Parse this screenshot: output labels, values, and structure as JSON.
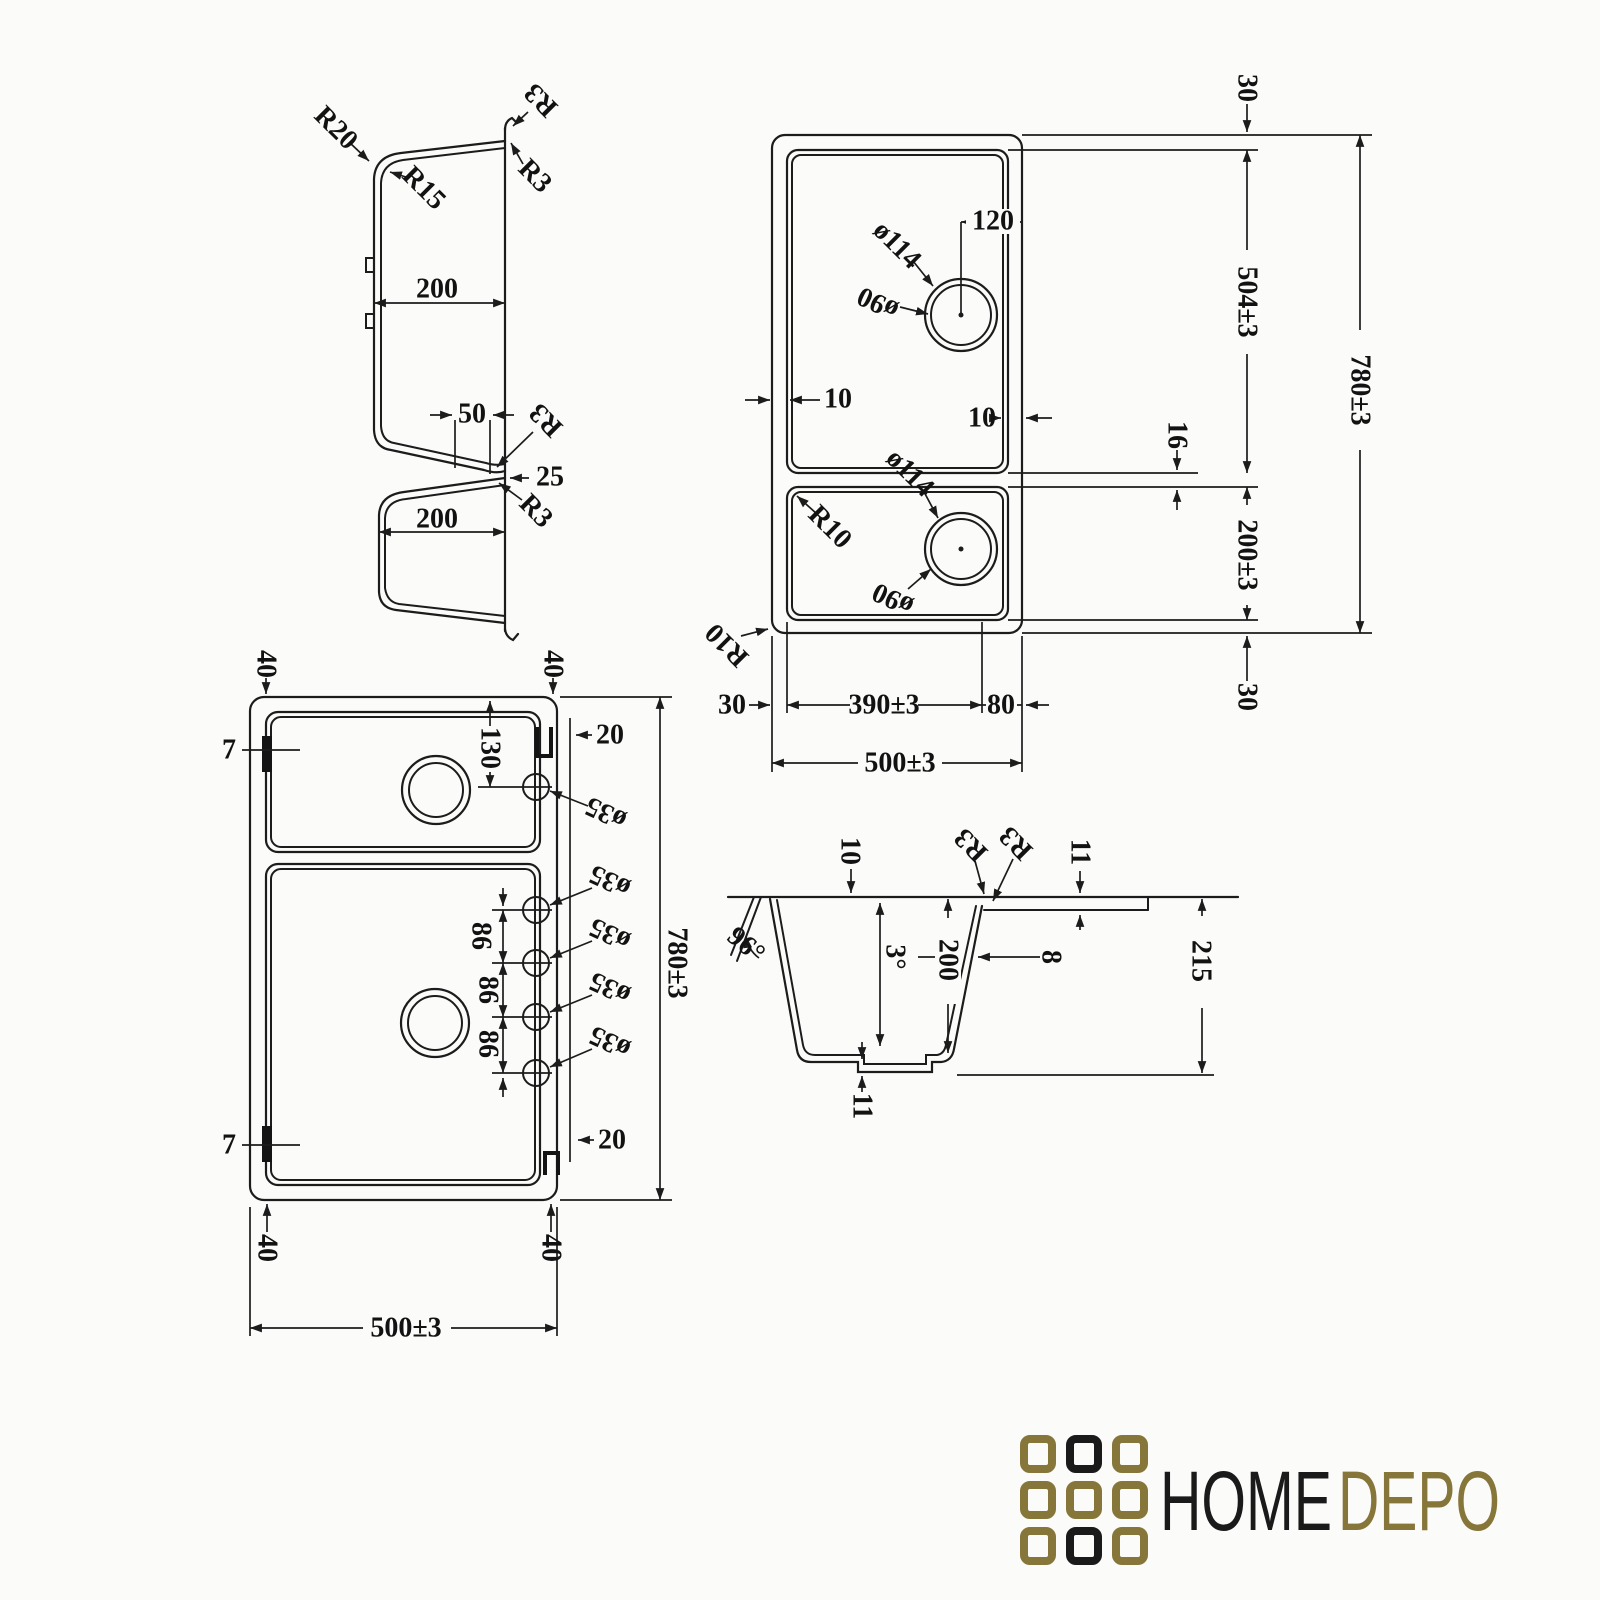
{
  "drawing": {
    "title": "sink-technical-drawing",
    "views": {
      "profile": {
        "r20": "R20",
        "r15": "R15",
        "r3_top": "R3",
        "r3_lip": "R3",
        "w200_upper": "200",
        "w50": "50",
        "r3_waist_upper": "R3",
        "w25": "25",
        "r3_waist_lower": "R3",
        "w200_lower": "200"
      },
      "plan_top": {
        "hole_offset120": "120",
        "dia114_upper": "ø114",
        "dia90_upper": "ø90",
        "edge10_left": "10",
        "edge10_right": "10",
        "divider16": "16",
        "dia114_lower": "ø114",
        "r10_bowl": "R10",
        "dia90_lower": "ø90",
        "r10_outer": "R10",
        "margin30_top": "30",
        "len504": "504±3",
        "len780": "780±3",
        "len200": "200±3",
        "margin30_bottom": "30",
        "margin30_left": "30",
        "w390": "390±3",
        "w80": "80",
        "w500": "500±3"
      },
      "plan_holes": {
        "c40_tl": "40",
        "c40_tr": "40",
        "c7_top": "7",
        "c20_top": "20",
        "h130": "130",
        "dia35_1": "ø35",
        "dia35_2": "ø35",
        "dia35_3": "ø35",
        "dia35_4": "ø35",
        "dia35_5": "ø35",
        "s86_1": "86",
        "s86_2": "86",
        "s86_3": "86",
        "len780": "780±3",
        "c20_bottom": "20",
        "c7_bottom": "7",
        "c40_bl": "40",
        "c40_br": "40",
        "w500": "500±3"
      },
      "section": {
        "rim10": "10",
        "r3_a": "R3",
        "r3_b": "R3",
        "step11_top": "11",
        "angle96": "96°",
        "angle3": "3°",
        "depth200": "200",
        "wall8": "8",
        "depth215": "215",
        "base11": "11"
      }
    },
    "logo": {
      "home": "HOME",
      "depo": "DEPO",
      "gold": "#87763a",
      "black": "#1a1a1a"
    }
  }
}
